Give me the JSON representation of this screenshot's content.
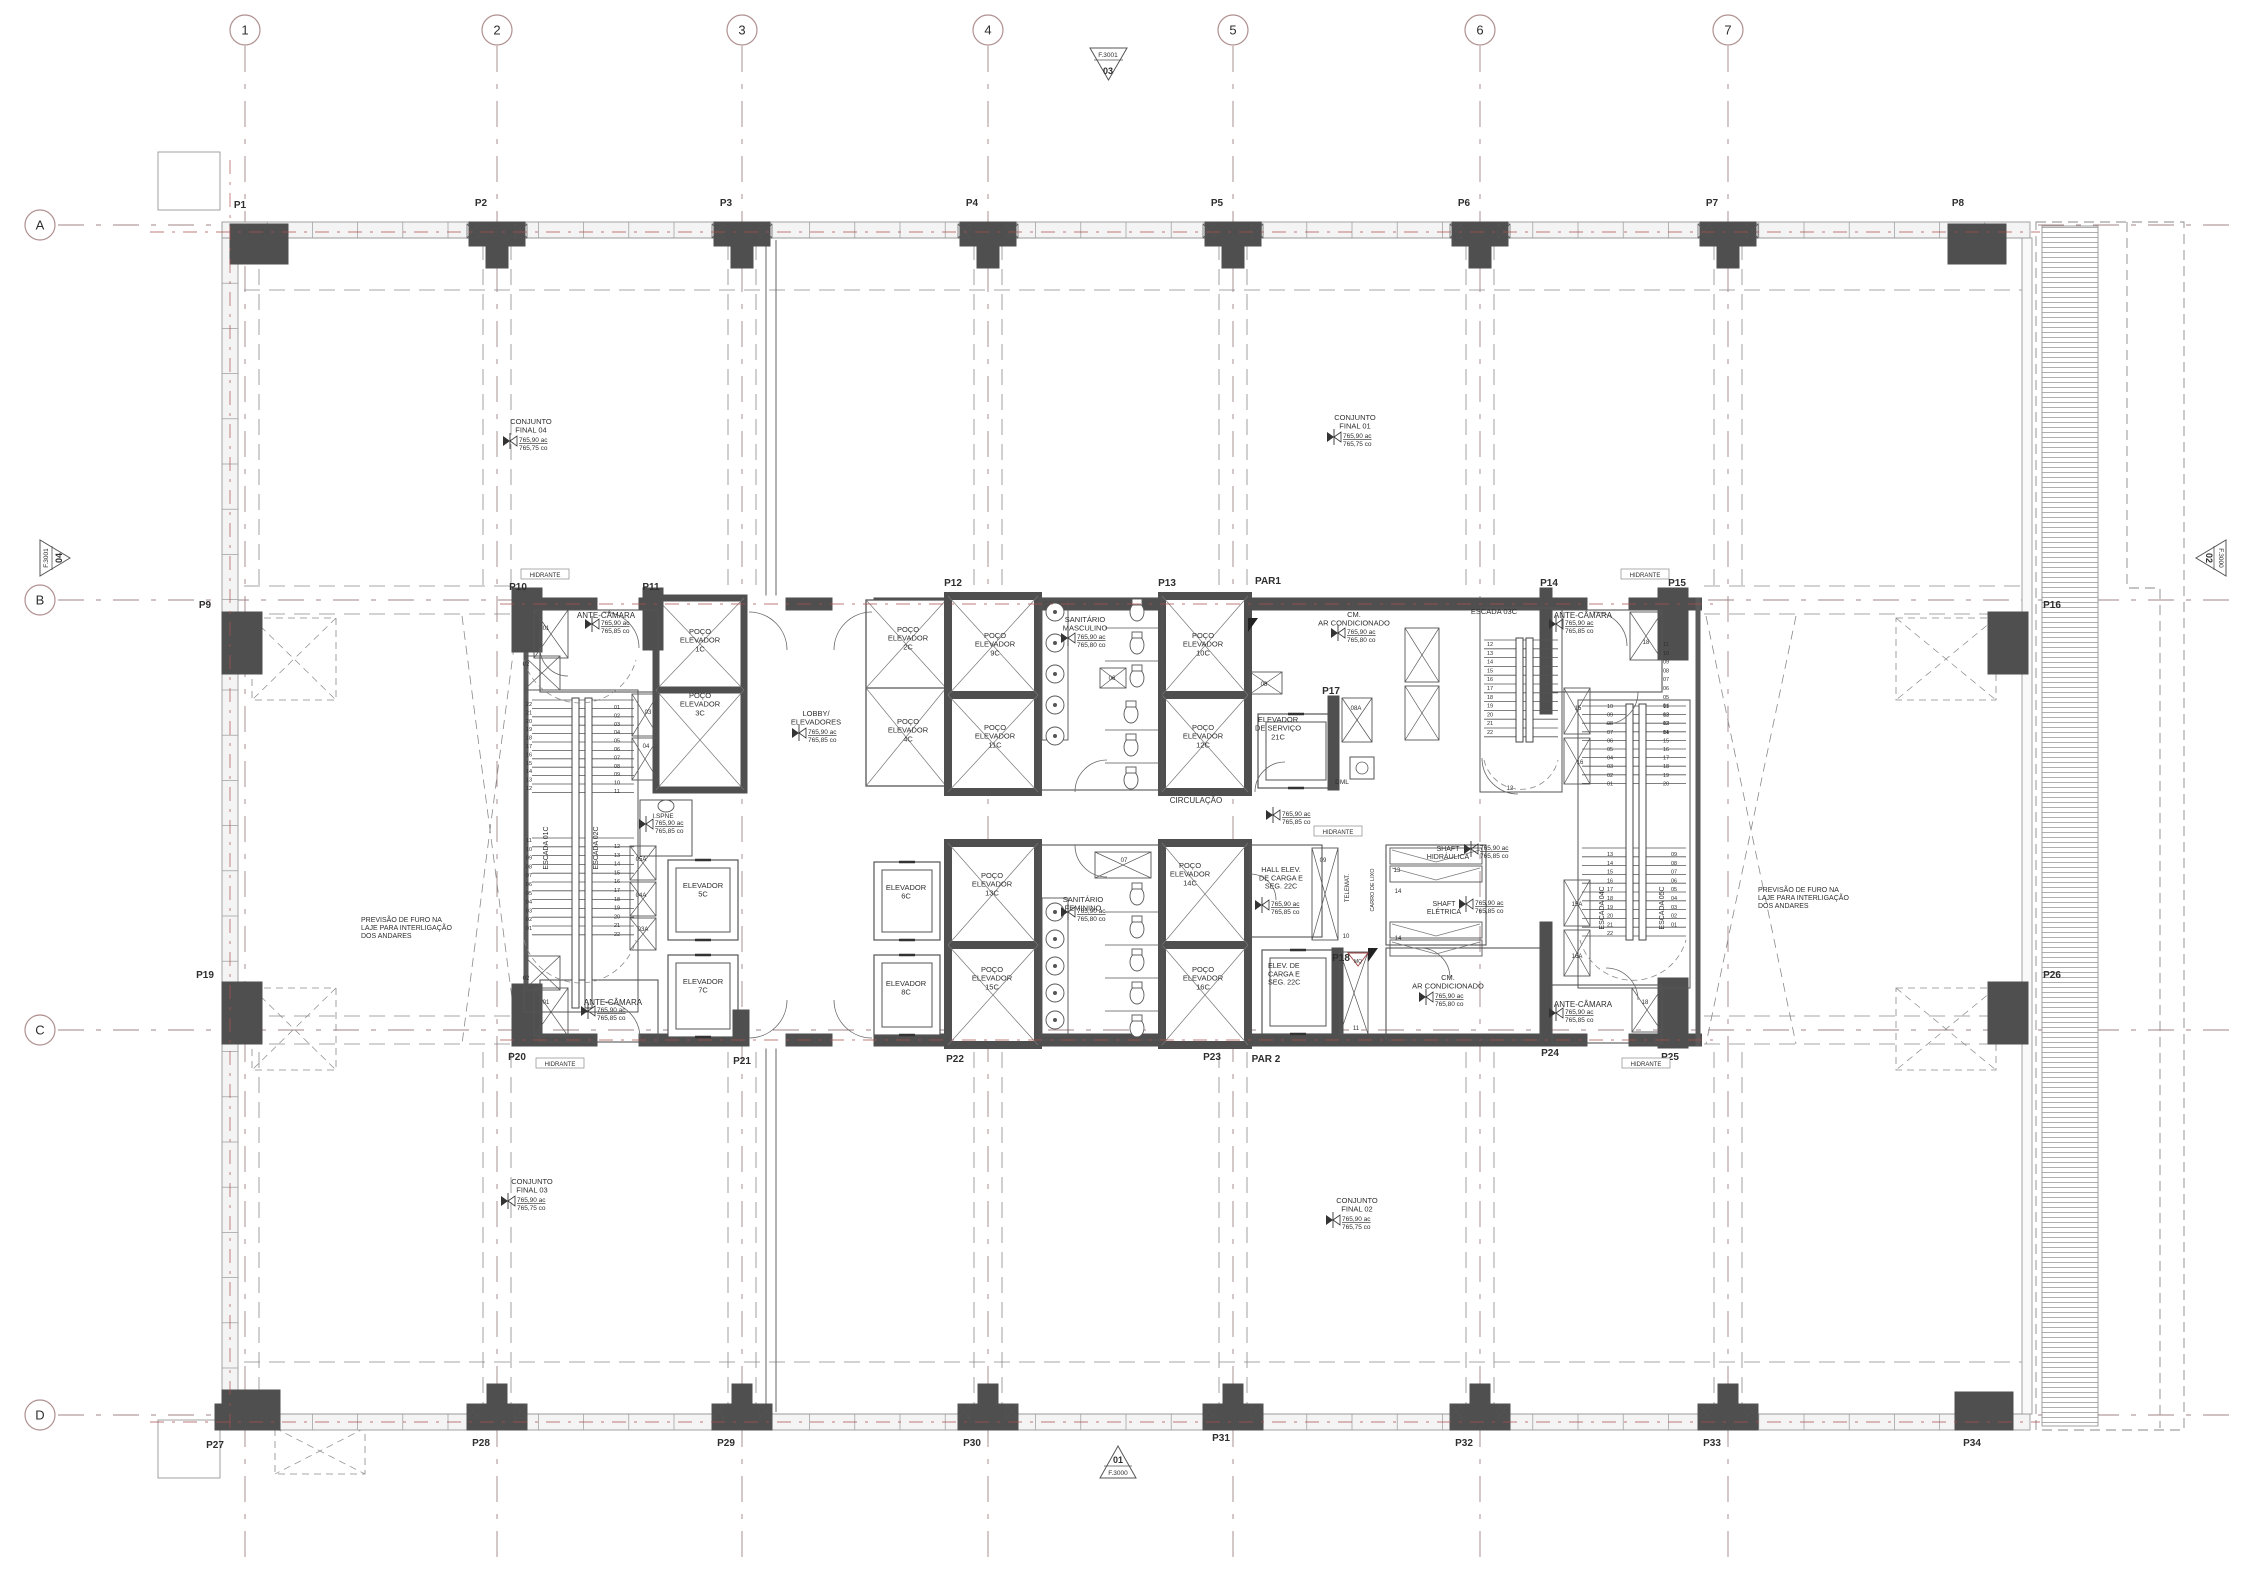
{
  "colors": {
    "grid_line": "#a08484",
    "axis_red": "#ad5050",
    "wall_dark": "#4f4f4f",
    "wall_mid": "#6b6b6b",
    "line": "#3c3c3c",
    "thin": "#555555",
    "dash_gray": "#8a8a8a",
    "hatch": "#a5a5a5",
    "text": "#2e2e2e",
    "small_num": "#555555",
    "red_detail": "#a04040"
  },
  "grid": {
    "cols": [
      {
        "label": "1",
        "x": 245
      },
      {
        "label": "2",
        "x": 497
      },
      {
        "label": "3",
        "x": 742
      },
      {
        "label": "4",
        "x": 988
      },
      {
        "label": "5",
        "x": 1233
      },
      {
        "label": "6",
        "x": 1480
      },
      {
        "label": "7",
        "x": 1728
      }
    ],
    "rows": [
      {
        "label": "A",
        "y": 225
      },
      {
        "label": "B",
        "y": 600
      },
      {
        "label": "C",
        "y": 1030
      },
      {
        "label": "D",
        "y": 1415
      }
    ]
  },
  "ref_markers": {
    "top": {
      "small": "F.3001",
      "big": "03"
    },
    "bottom": {
      "big": "01",
      "small": "F.3000"
    },
    "left": {
      "small": "F.3001",
      "big": "04"
    },
    "right": {
      "big": "02",
      "small": "F.3000"
    }
  },
  "levels": [
    {
      "x": 510,
      "y": 441,
      "v1": "765,90 ac",
      "v2": "765,75 co"
    },
    {
      "x": 1334,
      "y": 437,
      "v1": "765,90 ac",
      "v2": "765,75 co"
    },
    {
      "x": 508,
      "y": 1201,
      "v1": "765,90 ac",
      "v2": "765,75 co"
    },
    {
      "x": 1333,
      "y": 1220,
      "v1": "765,90 ac",
      "v2": "765,75 co"
    },
    {
      "x": 592,
      "y": 624,
      "v1": "765,90 ac",
      "v2": "765,85 co"
    },
    {
      "x": 799,
      "y": 733,
      "v1": "765,90 ac",
      "v2": "765,85 co"
    },
    {
      "x": 1068,
      "y": 638,
      "v1": "765,90 ac",
      "v2": "765,80 co"
    },
    {
      "x": 1338,
      "y": 633,
      "v1": "765,90 ac",
      "v2": "765,80 co"
    },
    {
      "x": 1273,
      "y": 815,
      "v1": "765,90 ac",
      "v2": "765,85 co"
    },
    {
      "x": 1556,
      "y": 624,
      "v1": "765,90 ac",
      "v2": "765,85 co"
    },
    {
      "x": 1471,
      "y": 849,
      "v1": "765,90 ac",
      "v2": "765,85 co"
    },
    {
      "x": 1466,
      "y": 904,
      "v1": "765,90 ac",
      "v2": "765,85 co"
    },
    {
      "x": 1262,
      "y": 905,
      "v1": "765,90 ac",
      "v2": "765,85 co"
    },
    {
      "x": 1426,
      "y": 997,
      "v1": "765,90 ac",
      "v2": "765,80 co"
    },
    {
      "x": 1068,
      "y": 912,
      "v1": "765,90 ac",
      "v2": "765,80 co"
    },
    {
      "x": 588,
      "y": 1011,
      "v1": "765,90 ac",
      "v2": "765,85 co"
    },
    {
      "x": 1556,
      "y": 1013,
      "v1": "765,90 ac",
      "v2": "765,85 co"
    },
    {
      "x": 646,
      "y": 824,
      "v1": "765,90 ac",
      "v2": "765,85 co"
    }
  ],
  "annotations": [
    {
      "t": "P1",
      "x": 240,
      "y": 208,
      "s": 10,
      "w": 700
    },
    {
      "t": "P2",
      "x": 481,
      "y": 206,
      "s": 10,
      "w": 700
    },
    {
      "t": "P3",
      "x": 726,
      "y": 206,
      "s": 10,
      "w": 700
    },
    {
      "t": "P4",
      "x": 972,
      "y": 206,
      "s": 10,
      "w": 700
    },
    {
      "t": "P5",
      "x": 1217,
      "y": 206,
      "s": 10,
      "w": 700
    },
    {
      "t": "P6",
      "x": 1464,
      "y": 206,
      "s": 10,
      "w": 700
    },
    {
      "t": "P7",
      "x": 1712,
      "y": 206,
      "s": 10,
      "w": 700
    },
    {
      "t": "P8",
      "x": 1958,
      "y": 206,
      "s": 10,
      "w": 700
    },
    {
      "t": "P9",
      "x": 205,
      "y": 608,
      "s": 10,
      "w": 700
    },
    {
      "t": "P16",
      "x": 2052,
      "y": 608,
      "s": 10,
      "w": 700
    },
    {
      "t": "P19",
      "x": 205,
      "y": 978,
      "s": 10,
      "w": 700
    },
    {
      "t": "P26",
      "x": 2052,
      "y": 978,
      "s": 10,
      "w": 700
    },
    {
      "t": "P27",
      "x": 215,
      "y": 1448,
      "s": 10,
      "w": 700
    },
    {
      "t": "P28",
      "x": 481,
      "y": 1446,
      "s": 10,
      "w": 700
    },
    {
      "t": "P29",
      "x": 726,
      "y": 1446,
      "s": 10,
      "w": 700
    },
    {
      "t": "P30",
      "x": 972,
      "y": 1446,
      "s": 10,
      "w": 700
    },
    {
      "t": "P31",
      "x": 1221,
      "y": 1441,
      "s": 10,
      "w": 700
    },
    {
      "t": "P32",
      "x": 1464,
      "y": 1446,
      "s": 10,
      "w": 700
    },
    {
      "t": "P33",
      "x": 1712,
      "y": 1446,
      "s": 10,
      "w": 700
    },
    {
      "t": "P34",
      "x": 1972,
      "y": 1446,
      "s": 10,
      "w": 700
    },
    {
      "t": "P10",
      "x": 518,
      "y": 590,
      "s": 10,
      "w": 700
    },
    {
      "t": "P11",
      "x": 651,
      "y": 590,
      "s": 10,
      "w": 700
    },
    {
      "t": "P12",
      "x": 953,
      "y": 586,
      "s": 10,
      "w": 700
    },
    {
      "t": "P13",
      "x": 1167,
      "y": 586,
      "s": 10,
      "w": 700
    },
    {
      "t": "PAR1",
      "x": 1268,
      "y": 584,
      "s": 10,
      "w": 700
    },
    {
      "t": "P14",
      "x": 1549,
      "y": 586,
      "s": 10,
      "w": 700
    },
    {
      "t": "P15",
      "x": 1677,
      "y": 586,
      "s": 10,
      "w": 700
    },
    {
      "t": "P17",
      "x": 1331,
      "y": 694,
      "s": 10,
      "w": 700
    },
    {
      "t": "P18",
      "x": 1341,
      "y": 961,
      "s": 10,
      "w": 700
    },
    {
      "t": "P20",
      "x": 517,
      "y": 1060,
      "s": 10,
      "w": 700
    },
    {
      "t": "P21",
      "x": 742,
      "y": 1064,
      "s": 10,
      "w": 700
    },
    {
      "t": "P22",
      "x": 955,
      "y": 1062,
      "s": 10,
      "w": 700
    },
    {
      "t": "P23",
      "x": 1212,
      "y": 1060,
      "s": 10,
      "w": 700
    },
    {
      "t": "PAR 2",
      "x": 1266,
      "y": 1062,
      "s": 10,
      "w": 700
    },
    {
      "t": "P24",
      "x": 1550,
      "y": 1056,
      "s": 10,
      "w": 700
    },
    {
      "t": "P25",
      "x": 1670,
      "y": 1060,
      "s": 10,
      "w": 700
    },
    {
      "lines": [
        "CONJUNTO",
        "FINAL  04"
      ],
      "x": 531,
      "y": 424,
      "s": 7.5
    },
    {
      "lines": [
        "CONJUNTO",
        "FINAL  01"
      ],
      "x": 1355,
      "y": 420,
      "s": 7.5
    },
    {
      "lines": [
        "CONJUNTO",
        "FINAL  03"
      ],
      "x": 532,
      "y": 1184,
      "s": 7.5
    },
    {
      "lines": [
        "CONJUNTO",
        "FINAL  02"
      ],
      "x": 1357,
      "y": 1203,
      "s": 7.5
    },
    {
      "lines": [
        "PREVISÃO  DE  FURO  NA",
        "LAJE  PARA  INTERLIGAÇÃO",
        "DOS  ANDARES"
      ],
      "x": 361,
      "y": 922,
      "s": 7,
      "a": "start"
    },
    {
      "lines": [
        "PREVISÃO  DE  FURO  NA",
        "LAJE  PARA  INTERLIGAÇÃO",
        "DOS  ANDARES"
      ],
      "x": 1758,
      "y": 892,
      "s": 7,
      "a": "start"
    },
    {
      "t": "ANTE-CÂMARA",
      "x": 606,
      "y": 618,
      "s": 8
    },
    {
      "t": "ANTE-CÂMARA",
      "x": 1583,
      "y": 618,
      "s": 8
    },
    {
      "t": "ANTE-CÂMARA",
      "x": 613,
      "y": 1005,
      "s": 8
    },
    {
      "t": "ANTE-CÂMARA",
      "x": 1583,
      "y": 1007,
      "s": 8
    },
    {
      "lines": [
        "POÇO",
        "ELEVADOR",
        "1C"
      ],
      "x": 700,
      "y": 634,
      "s": 7.5
    },
    {
      "lines": [
        "POÇO",
        "ELEVADOR",
        "3C"
      ],
      "x": 700,
      "y": 698,
      "s": 7.5
    },
    {
      "lines": [
        "POÇO",
        "ELEVADOR",
        "2C"
      ],
      "x": 908,
      "y": 632,
      "s": 7.5
    },
    {
      "lines": [
        "POÇO",
        "ELEVADOR",
        "4C"
      ],
      "x": 908,
      "y": 724,
      "s": 7.5
    },
    {
      "lines": [
        "POÇO",
        "ELEVADOR",
        "9C"
      ],
      "x": 995,
      "y": 638,
      "s": 7.5
    },
    {
      "lines": [
        "POÇO",
        "ELEVADOR",
        "11C"
      ],
      "x": 995,
      "y": 730,
      "s": 7.5
    },
    {
      "lines": [
        "POÇO",
        "ELEVADOR",
        "10C"
      ],
      "x": 1203,
      "y": 638,
      "s": 7.5
    },
    {
      "lines": [
        "POÇO",
        "ELEVADOR",
        "12C"
      ],
      "x": 1203,
      "y": 730,
      "s": 7.5
    },
    {
      "lines": [
        "POÇO",
        "ELEVADOR",
        "13C"
      ],
      "x": 992,
      "y": 878,
      "s": 7.5
    },
    {
      "lines": [
        "POÇO",
        "ELEVADOR",
        "15C"
      ],
      "x": 992,
      "y": 972,
      "s": 7.5
    },
    {
      "lines": [
        "POÇO",
        "ELEVADOR",
        "14C"
      ],
      "x": 1190,
      "y": 868,
      "s": 7.5
    },
    {
      "lines": [
        "POÇO",
        "ELEVADOR",
        "16C"
      ],
      "x": 1203,
      "y": 972,
      "s": 7.5
    },
    {
      "lines": [
        "LOBBY/",
        "ELEVADORES"
      ],
      "x": 816,
      "y": 716,
      "s": 7.5
    },
    {
      "lines": [
        "SANITÁRIO",
        "MASCULINO"
      ],
      "x": 1085,
      "y": 622,
      "s": 7.5
    },
    {
      "lines": [
        "SANITÁRIO",
        "FEMININO"
      ],
      "x": 1083,
      "y": 902,
      "s": 7.5
    },
    {
      "lines": [
        "CM.",
        "AR  CONDICIONADO"
      ],
      "x": 1354,
      "y": 617,
      "s": 7.5
    },
    {
      "lines": [
        "CM.",
        "AR  CONDICIONADO"
      ],
      "x": 1448,
      "y": 980,
      "s": 7.5
    },
    {
      "lines": [
        "ELEVADOR",
        "DE  SERVIÇO",
        "21C"
      ],
      "x": 1278,
      "y": 722,
      "s": 7.5
    },
    {
      "lines": [
        "ELEVADOR",
        "5C"
      ],
      "x": 703,
      "y": 888,
      "s": 7.5
    },
    {
      "lines": [
        "ELEVADOR",
        "7C"
      ],
      "x": 703,
      "y": 984,
      "s": 7.5
    },
    {
      "lines": [
        "ELEVADOR",
        "6C"
      ],
      "x": 906,
      "y": 890,
      "s": 7.5
    },
    {
      "lines": [
        "ELEVADOR",
        "8C"
      ],
      "x": 906,
      "y": 986,
      "s": 7.5
    },
    {
      "lines": [
        "HALL  ELEV.",
        "DE  CARGA  E",
        "SEG.  22C"
      ],
      "x": 1281,
      "y": 872,
      "s": 7.2
    },
    {
      "lines": [
        "ELEV.  DE",
        "CARGA  E",
        "SEG.  22C"
      ],
      "x": 1268,
      "y": 968,
      "s": 7.2,
      "a": "start"
    },
    {
      "lines": [
        "SHAFT",
        "HIDRÁULICA"
      ],
      "x": 1448,
      "y": 851,
      "s": 7
    },
    {
      "lines": [
        "SHAFT",
        "ELÉTRICA"
      ],
      "x": 1444,
      "y": 906,
      "s": 7
    },
    {
      "t": "DML",
      "x": 1342,
      "y": 784,
      "s": 6.5
    },
    {
      "t": "CIRCULAÇÃO",
      "x": 1196,
      "y": 803,
      "s": 8
    },
    {
      "t": "ESCADA  03C",
      "x": 1494,
      "y": 614,
      "s": 7.5
    },
    {
      "t": "ESCADA  01C",
      "x": 548,
      "y": 848,
      "s": 7,
      "r": -90
    },
    {
      "t": "ESCADA  02C",
      "x": 598,
      "y": 848,
      "s": 7,
      "r": -90
    },
    {
      "t": "ESCADA  04C",
      "x": 1604,
      "y": 908,
      "s": 7,
      "r": -90
    },
    {
      "t": "ESCADA  05C",
      "x": 1664,
      "y": 908,
      "s": 7,
      "r": -90
    },
    {
      "t": "TELEMAT.",
      "x": 1349,
      "y": 888,
      "s": 6,
      "r": -90
    },
    {
      "t": "CARRO  DE  LIXO",
      "x": 1374,
      "y": 890,
      "s": 5.5,
      "r": -90
    },
    {
      "t": "I.SPNE",
      "x": 663,
      "y": 818,
      "s": 6.5
    },
    {
      "t": "HIDRANTE",
      "x": 545,
      "y": 577,
      "s": 6,
      "bx": 1
    },
    {
      "t": "HIDRANTE",
      "x": 1645,
      "y": 577,
      "s": 6,
      "bx": 1
    },
    {
      "t": "HIDRANTE",
      "x": 560,
      "y": 1066,
      "s": 6,
      "bx": 1
    },
    {
      "t": "HIDRANTE",
      "x": 1646,
      "y": 1066,
      "s": 6,
      "bx": 1
    },
    {
      "t": "HIDRANTE",
      "x": 1338,
      "y": 834,
      "s": 6,
      "bx": 1
    },
    {
      "t": "01",
      "x": 546,
      "y": 630,
      "s": 6,
      "c": "#555555"
    },
    {
      "t": "02",
      "x": 526,
      "y": 666,
      "s": 6,
      "c": "#555555"
    },
    {
      "t": "03",
      "x": 648,
      "y": 714,
      "s": 6,
      "c": "#555555"
    },
    {
      "t": "04",
      "x": 646,
      "y": 748,
      "s": 6,
      "c": "#555555"
    },
    {
      "t": "05A",
      "x": 641,
      "y": 861,
      "s": 6,
      "c": "#555555"
    },
    {
      "t": "04A",
      "x": 641,
      "y": 897,
      "s": 6,
      "c": "#555555"
    },
    {
      "t": "03A",
      "x": 643,
      "y": 931,
      "s": 6,
      "c": "#555555"
    },
    {
      "t": "02",
      "x": 526,
      "y": 980,
      "s": 6,
      "c": "#555555"
    },
    {
      "t": "01",
      "x": 546,
      "y": 1004,
      "s": 6,
      "c": "#555555"
    },
    {
      "t": "06",
      "x": 1112,
      "y": 680,
      "s": 6,
      "c": "#555555"
    },
    {
      "t": "07",
      "x": 1124,
      "y": 862,
      "s": 6,
      "c": "#555555"
    },
    {
      "t": "08",
      "x": 1264,
      "y": 686,
      "s": 6,
      "c": "#555555"
    },
    {
      "t": "08A",
      "x": 1356,
      "y": 710,
      "s": 6,
      "c": "#555555"
    },
    {
      "t": "09",
      "x": 1323,
      "y": 862,
      "s": 6,
      "c": "#555555"
    },
    {
      "t": "10",
      "x": 1346,
      "y": 938,
      "s": 6,
      "c": "#555555"
    },
    {
      "t": "11",
      "x": 1356,
      "y": 1030,
      "s": 6,
      "c": "#555555"
    },
    {
      "t": "13",
      "x": 1397,
      "y": 872,
      "s": 6,
      "c": "#555555"
    },
    {
      "t": "14",
      "x": 1398,
      "y": 893,
      "s": 6,
      "c": "#555555"
    },
    {
      "t": "14",
      "x": 1398,
      "y": 940,
      "s": 6,
      "c": "#555555"
    },
    {
      "t": "12",
      "x": 1510,
      "y": 790,
      "s": 6,
      "c": "#555555"
    },
    {
      "t": "15",
      "x": 1578,
      "y": 710,
      "s": 6,
      "c": "#555555"
    },
    {
      "t": "16",
      "x": 1580,
      "y": 764,
      "s": 6,
      "c": "#555555"
    },
    {
      "t": "15A",
      "x": 1577,
      "y": 906,
      "s": 6,
      "c": "#555555"
    },
    {
      "t": "16A",
      "x": 1577,
      "y": 958,
      "s": 6,
      "c": "#555555"
    },
    {
      "t": "18",
      "x": 1646,
      "y": 644,
      "s": 6,
      "c": "#555555"
    },
    {
      "t": "18",
      "x": 1645,
      "y": 1004,
      "s": 6,
      "c": "#555555"
    },
    {
      "t": "MQ",
      "x": 1358,
      "y": 963,
      "s": 5,
      "c": "#a04040"
    }
  ],
  "number_columns": [
    {
      "x": 529,
      "y0": 706,
      "dy": 8.4,
      "v": [
        "22",
        "21",
        "20",
        "19",
        "18",
        "17",
        "16",
        "15",
        "14",
        "13",
        "12"
      ]
    },
    {
      "x": 617,
      "y0": 709,
      "dy": 8.4,
      "v": [
        "01",
        "02",
        "03",
        "04",
        "05",
        "06",
        "07",
        "08",
        "09",
        "10",
        "11"
      ]
    },
    {
      "x": 529,
      "y0": 842,
      "dy": 8.8,
      "v": [
        "11",
        "10",
        "09",
        "08",
        "07",
        "06",
        "05",
        "04",
        "03",
        "02",
        "01"
      ]
    },
    {
      "x": 617,
      "y0": 848,
      "dy": 8.8,
      "v": [
        "12",
        "13",
        "14",
        "15",
        "16",
        "17",
        "18",
        "19",
        "20",
        "21",
        "22"
      ]
    },
    {
      "x": 1490,
      "y0": 646,
      "dy": 8.8,
      "v": [
        "12",
        "13",
        "14",
        "15",
        "16",
        "17",
        "18",
        "19",
        "20",
        "21",
        "22"
      ]
    },
    {
      "x": 1666,
      "y0": 646,
      "dy": 8.8,
      "v": [
        "11",
        "10",
        "09",
        "08",
        "07",
        "06",
        "05",
        "04",
        "03",
        "02",
        "01"
      ]
    },
    {
      "x": 1610,
      "y0": 708,
      "dy": 8.6,
      "v": [
        "10",
        "09",
        "08",
        "07",
        "06",
        "05",
        "04",
        "03",
        "02",
        "01"
      ]
    },
    {
      "x": 1666,
      "y0": 708,
      "dy": 8.6,
      "v": [
        "11",
        "12",
        "13",
        "14",
        "15",
        "16",
        "17",
        "18",
        "19",
        "20"
      ]
    },
    {
      "x": 1610,
      "y0": 856,
      "dy": 8.8,
      "v": [
        "13",
        "14",
        "15",
        "16",
        "17",
        "18",
        "19",
        "20",
        "21",
        "22"
      ]
    },
    {
      "x": 1674,
      "y0": 856,
      "dy": 8.8,
      "v": [
        "09",
        "08",
        "07",
        "06",
        "05",
        "04",
        "03",
        "02",
        "01"
      ]
    }
  ]
}
